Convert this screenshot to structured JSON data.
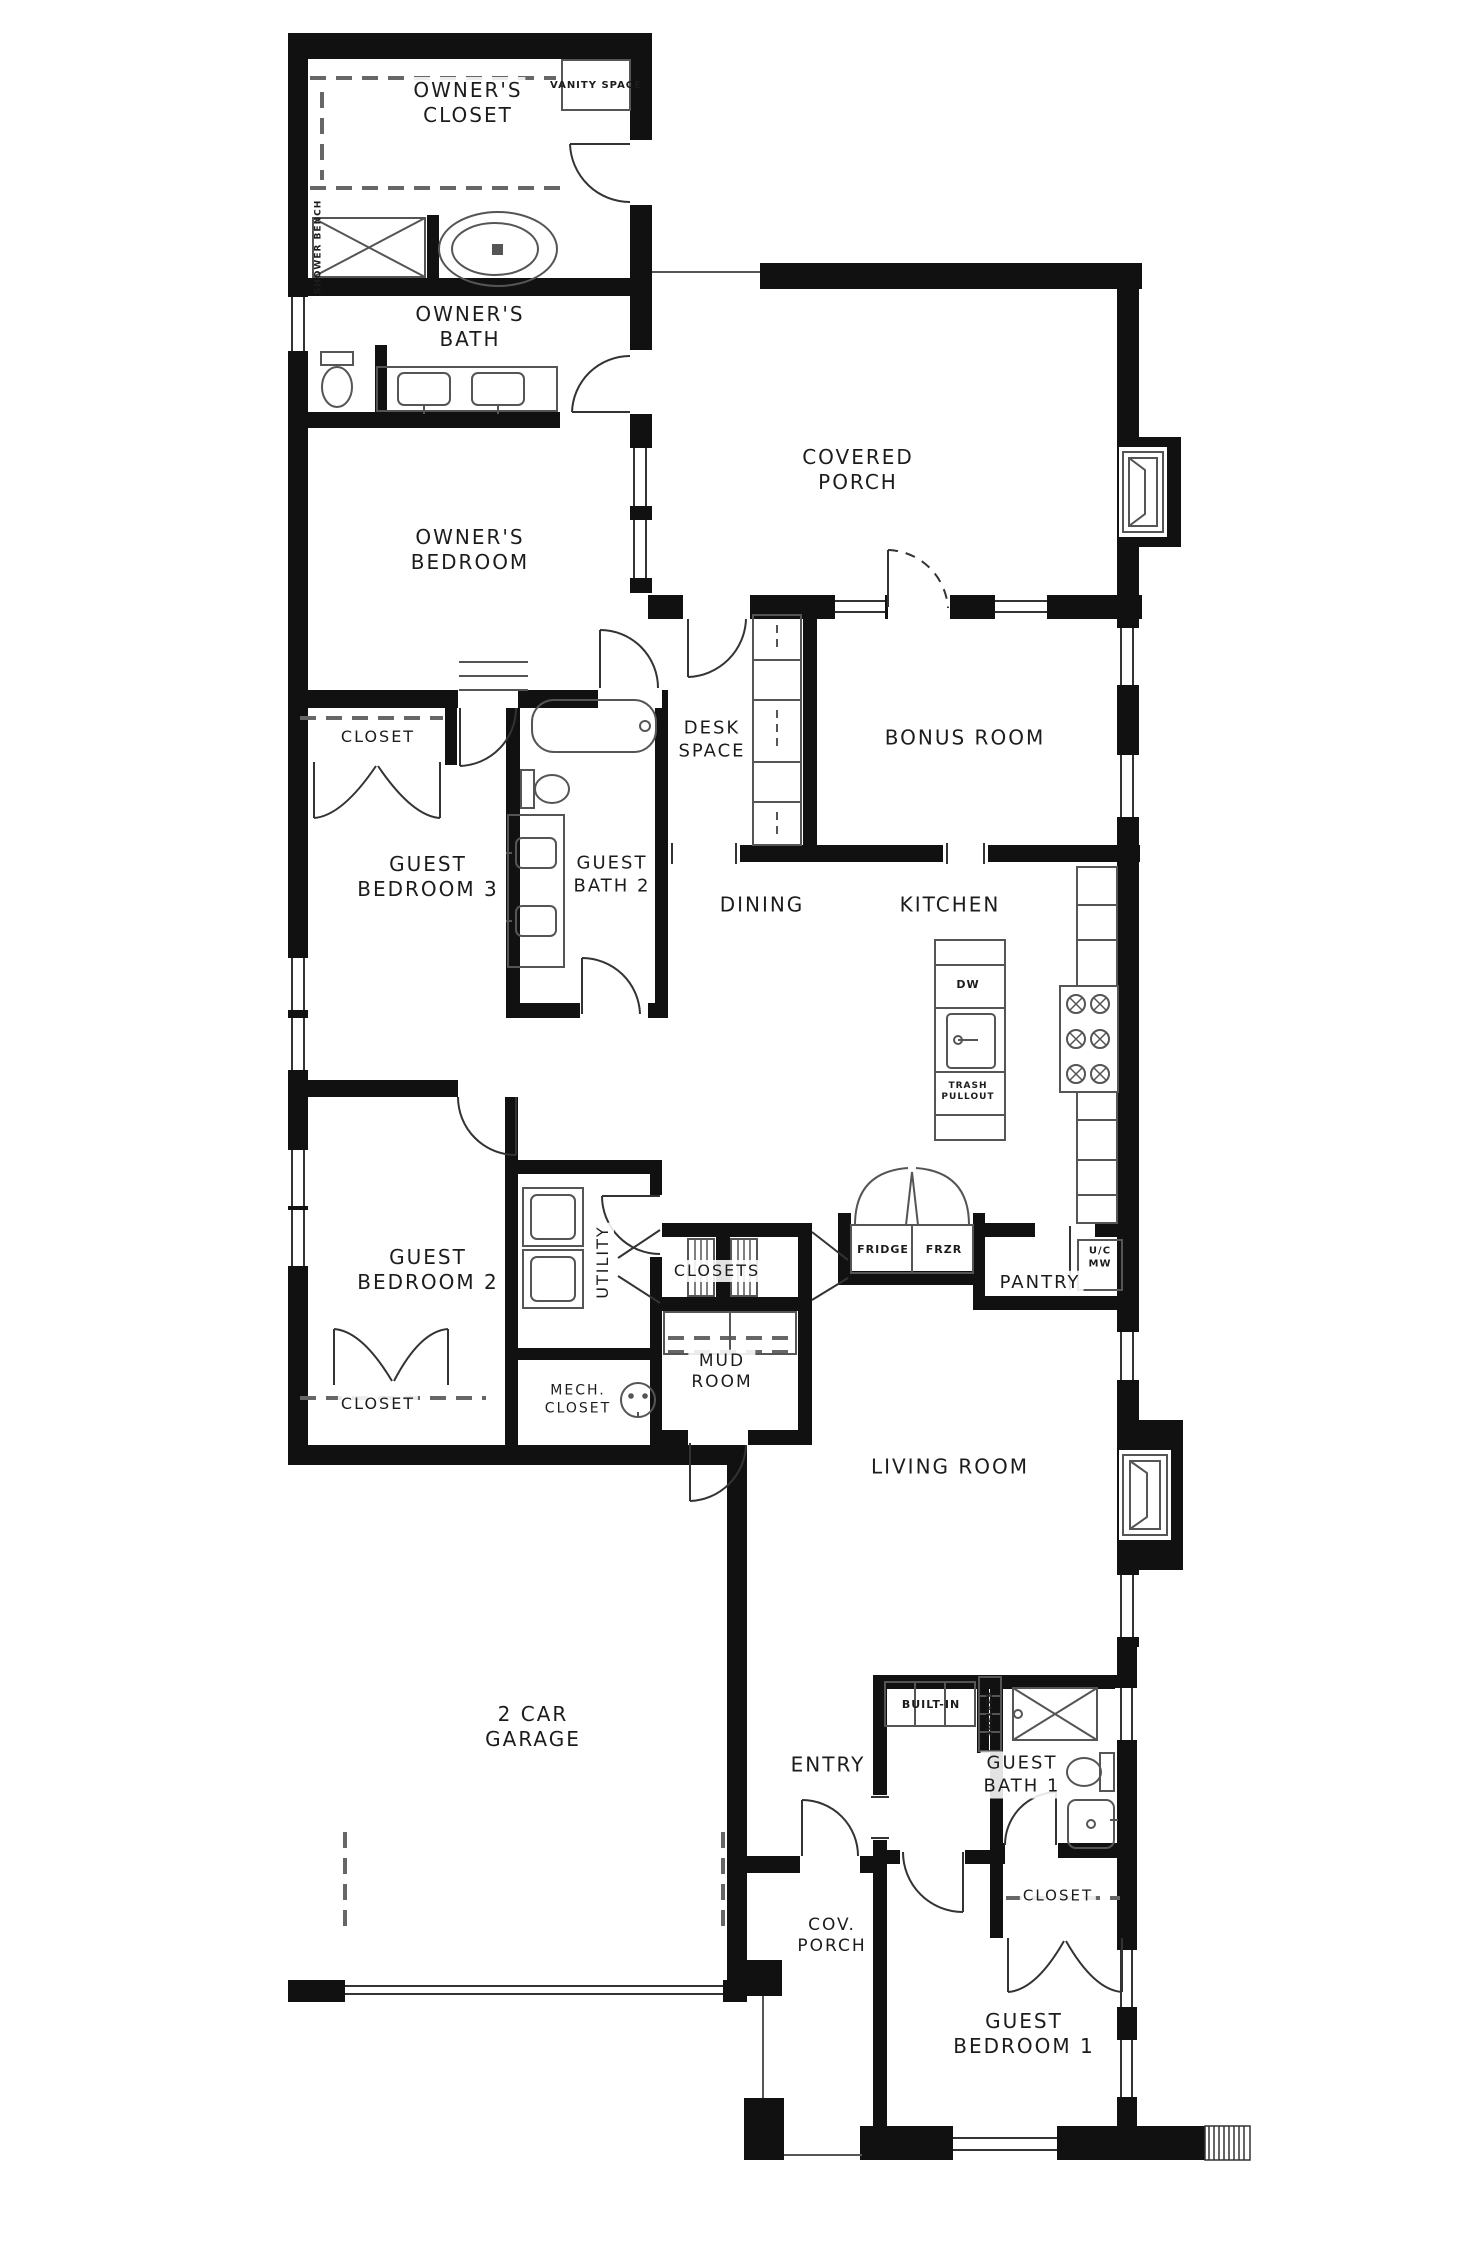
{
  "title": "Single-story house floor plan",
  "colors": {
    "wall": "#111111",
    "fixture_line": "#555555",
    "background": "#ffffff"
  },
  "labels": {
    "owners_closet": "OWNER'S\nCLOSET",
    "vanity_space": "VANITY SPACE",
    "shower_bench": "SHOWER BENCH",
    "owners_bath": "OWNER'S\nBATH",
    "owners_bedroom": "OWNER'S\nBEDROOM",
    "covered_porch": "COVERED\nPORCH",
    "bonus_room": "BONUS ROOM",
    "desk_space": "DESK\nSPACE",
    "closet_bedroom3": "CLOSET",
    "guest_bedroom3": "GUEST\nBEDROOM 3",
    "guest_bath2": "GUEST\nBATH 2",
    "dining": "DINING",
    "kitchen": "KITCHEN",
    "dw": "DW",
    "trash_pullout": "TRASH\nPULLOUT",
    "fridge": "FRIDGE",
    "frzr": "FRZR",
    "pantry": "PANTRY",
    "uc_mw": "U/C\nMW",
    "utility": "UTILITY",
    "closets": "CLOSETS",
    "guest_bedroom2": "GUEST\nBEDROOM 2",
    "closet_bedroom2": "CLOSET",
    "mech_closet": "MECH.\nCLOSET",
    "mud_room": "MUD\nROOM",
    "living_room": "LIVING ROOM",
    "garage": "2 CAR\nGARAGE",
    "entry": "ENTRY",
    "built_in": "BUILT-IN",
    "shelves": "SHELVES",
    "guest_bath1": "GUEST\nBATH 1",
    "cov_porch": "COV.\nPORCH",
    "closet_bedroom1": "CLOSET",
    "guest_bedroom1": "GUEST\nBEDROOM 1"
  }
}
